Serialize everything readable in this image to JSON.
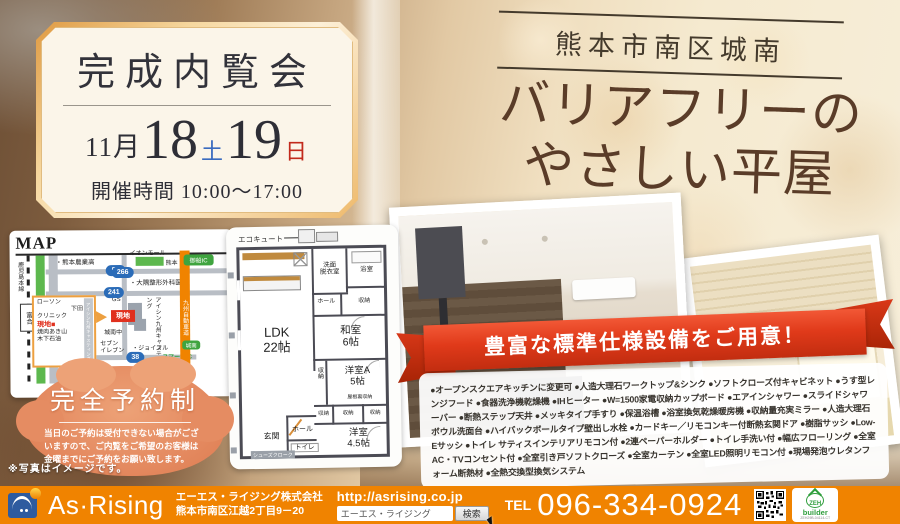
{
  "event": {
    "title": "完成内覧会",
    "month": "11月",
    "day1": "18",
    "day1_dow": "土",
    "day2": "19",
    "day2_dow": "日",
    "time": "開催時間 10:00～17:00"
  },
  "location": {
    "area": "熊本市南区城南",
    "headline1": "バリアフリーの",
    "headline2": "やさしい平屋"
  },
  "map": {
    "title": "MAP",
    "rail": "鹿児島本線",
    "station": "富合",
    "shinkansen": "九州新幹線",
    "road3": "国道3号線",
    "route50": "50",
    "route241": "241",
    "route266": "266",
    "route38": "38",
    "school": "・熊本農業高",
    "mall1": "イオンモール",
    "mall2": "熊本",
    "clinic": "・大隅整形外科医院",
    "gs": "GS",
    "site": "現地",
    "jhs": "城南中",
    "seven1": "セブン",
    "seven2": "イレブン",
    "joyful": "・ジョイフル",
    "aisin": "アイシン九州キャスティング",
    "expressway": "九州自動車道",
    "mifune_ic": "御船IC",
    "smart_ic1": "城南",
    "smart_ic2": "スマートIC",
    "inset": {
      "lawson": "ローソン",
      "shimoda1": "下田",
      "shimoda2": "クリニック",
      "site": "現地■",
      "yakiniku": "焼肉あき山",
      "oil": "木下石油",
      "aisin": "アイシン九州キャスティング"
    }
  },
  "floorplan": {
    "ecocute": "エコキュート",
    "ldk1": "LDK",
    "ldk2": "22帖",
    "washroom1": "洗面",
    "washroom2": "脱衣室",
    "bath": "浴室",
    "hall1": "ホール",
    "closet_top": "収納",
    "washitsu1": "和室",
    "washitsu2": "6帖",
    "roomA1": "洋室A",
    "roomA2": "5帖",
    "attic": "屋根裏収納",
    "closet_v": "収納",
    "closet1": "収納",
    "closet2": "収納",
    "closet3": "収納",
    "genkan": "玄関",
    "hall2": "ホール",
    "toilet": "トイレ",
    "roomB1": "洋室",
    "roomB2": "4.5帖",
    "shoes": "シューズクローク"
  },
  "ribbon": {
    "text": "豊富な標準仕様設備をご用意！"
  },
  "features": {
    "items": [
      "オープンスクエアキッチンに変更可",
      "人造大理石ワークトップ&シンク",
      "ソフトクローズ付キャビネット",
      "うす型レンジフード",
      "食器洗浄機乾燥機",
      "IHヒーター",
      "W=1500家電収納カップボード",
      "エアインシャワー",
      "スライドシャワーバー",
      "断熱ステップ天井",
      "メッキタイプ手すり",
      "保温浴槽",
      "浴室換気乾燥暖房機",
      "収納量充実ミラー",
      "人造大理石ボウル洗面台",
      "ハイバックボールタイプ壁出し水栓",
      "カードキー／リモコンキー付断熱玄関ドア",
      "樹脂サッシ",
      "Low-Eサッシ",
      "トイレ サティスインテリアリモコン付",
      "2連ペーパーホルダー",
      "トイレ手洗い付",
      "幅広フローリング",
      "全室AC・TVコンセント付",
      "全室引き戸ソフトクローズ",
      "全室カーテン",
      "全室LED照明リモコン付",
      "現場発泡ウレタンフォーム断熱材",
      "全熱交換型換気システム"
    ]
  },
  "reservation": {
    "title": "完全予約制",
    "note": "当日のご予約は受付できない場合がございますので、ご内覧をご希望のお客様は金曜までにご予約をお願い致します。"
  },
  "photo_note": "※写真はイメージです。",
  "footer": {
    "brand": "As·Rising",
    "company": "エーエス・ライジング株式会社",
    "address": "熊本市南区江越2丁目9－20",
    "url": "http://asrising.co.jp",
    "search_value": "エーエス・ライジング",
    "search_button": "検索",
    "tel_label": "TEL",
    "tel_number": "096-334-0924",
    "zeh_name": "ZEH",
    "zeh_sub": "builder",
    "zeh_code": "ZEH29B-04114-CT"
  },
  "colors": {
    "footer_orange": "#F08300",
    "ribbon_red": "#DD3517",
    "site_red": "#E0301E",
    "headline_brown": "#5A3C28",
    "saturday_blue": "#3A6BBF",
    "sunday_red": "#C22A1C"
  }
}
